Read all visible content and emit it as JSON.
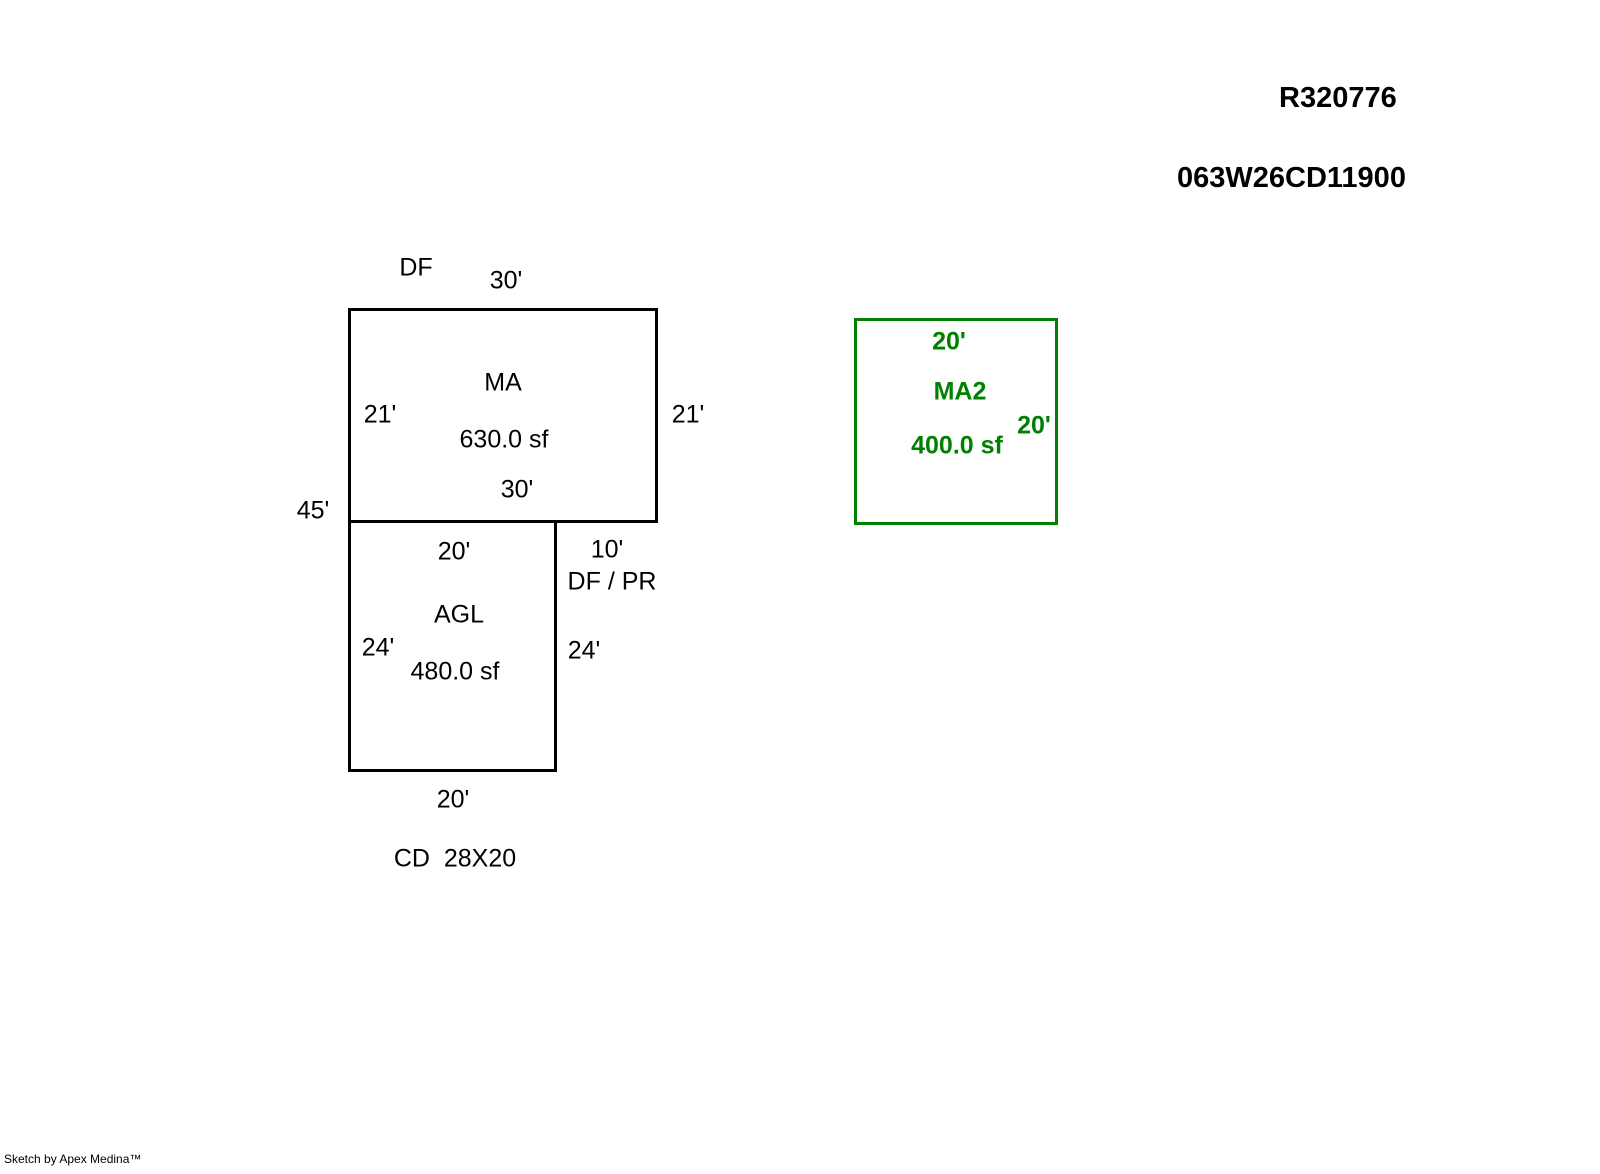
{
  "header": {
    "parcel_id": "R320776",
    "map_taxlot": "063W26CD11900"
  },
  "colors": {
    "line_black": "#000000",
    "accent_green": "#008000",
    "background": "#ffffff"
  },
  "sketch": {
    "rects": [
      {
        "name": "ma",
        "x": 348,
        "y": 308,
        "w": 310,
        "h": 215,
        "stroke": "#000000"
      },
      {
        "name": "agl",
        "x": 348,
        "y": 520,
        "w": 209,
        "h": 252,
        "stroke": "#000000"
      },
      {
        "name": "ma2",
        "x": 854,
        "y": 318,
        "w": 204,
        "h": 207,
        "stroke": "#008000"
      }
    ],
    "labels": [
      {
        "name": "df-note",
        "text": "DF",
        "x": 416,
        "y": 268,
        "style": "black"
      },
      {
        "name": "ma-top-dim",
        "text": "30'",
        "x": 506,
        "y": 281,
        "style": "black"
      },
      {
        "name": "ma-title",
        "text": "MA",
        "x": 503,
        "y": 383,
        "style": "black"
      },
      {
        "name": "ma-left-dim",
        "text": "21'",
        "x": 380,
        "y": 415,
        "style": "black"
      },
      {
        "name": "ma-right-dim",
        "text": "21'",
        "x": 688,
        "y": 415,
        "style": "black"
      },
      {
        "name": "ma-area",
        "text": "630.0 sf",
        "x": 504,
        "y": 440,
        "style": "black"
      },
      {
        "name": "ma-bottom-dim",
        "text": "30'",
        "x": 517,
        "y": 490,
        "style": "black"
      },
      {
        "name": "left-total-dim",
        "text": "45'",
        "x": 313,
        "y": 511,
        "style": "black"
      },
      {
        "name": "agl-top-dim",
        "text": "20'",
        "x": 454,
        "y": 552,
        "style": "black"
      },
      {
        "name": "notch-dim",
        "text": "10'",
        "x": 607,
        "y": 550,
        "style": "black"
      },
      {
        "name": "df-pr-note",
        "text": "DF / PR",
        "x": 612,
        "y": 582,
        "style": "black"
      },
      {
        "name": "agl-title",
        "text": "AGL",
        "x": 459,
        "y": 615,
        "style": "black"
      },
      {
        "name": "agl-left-dim",
        "text": "24'",
        "x": 378,
        "y": 648,
        "style": "black"
      },
      {
        "name": "agl-right-dim",
        "text": "24'",
        "x": 584,
        "y": 651,
        "style": "black"
      },
      {
        "name": "agl-area",
        "text": "480.0 sf",
        "x": 455,
        "y": 672,
        "style": "black"
      },
      {
        "name": "agl-bottom-dim",
        "text": "20'",
        "x": 453,
        "y": 800,
        "style": "black"
      },
      {
        "name": "cd-note",
        "text": "CD  28X20",
        "x": 455,
        "y": 859,
        "style": "black"
      },
      {
        "name": "ma2-top-dim",
        "text": "20'",
        "x": 949,
        "y": 342,
        "style": "green"
      },
      {
        "name": "ma2-title",
        "text": "MA2",
        "x": 960,
        "y": 392,
        "style": "green"
      },
      {
        "name": "ma2-right-dim",
        "text": "20'",
        "x": 1034,
        "y": 426,
        "style": "green"
      },
      {
        "name": "ma2-area",
        "text": "400.0 sf",
        "x": 957,
        "y": 446,
        "style": "green"
      }
    ]
  },
  "footer": {
    "credit": "Sketch by Apex Medina™"
  }
}
